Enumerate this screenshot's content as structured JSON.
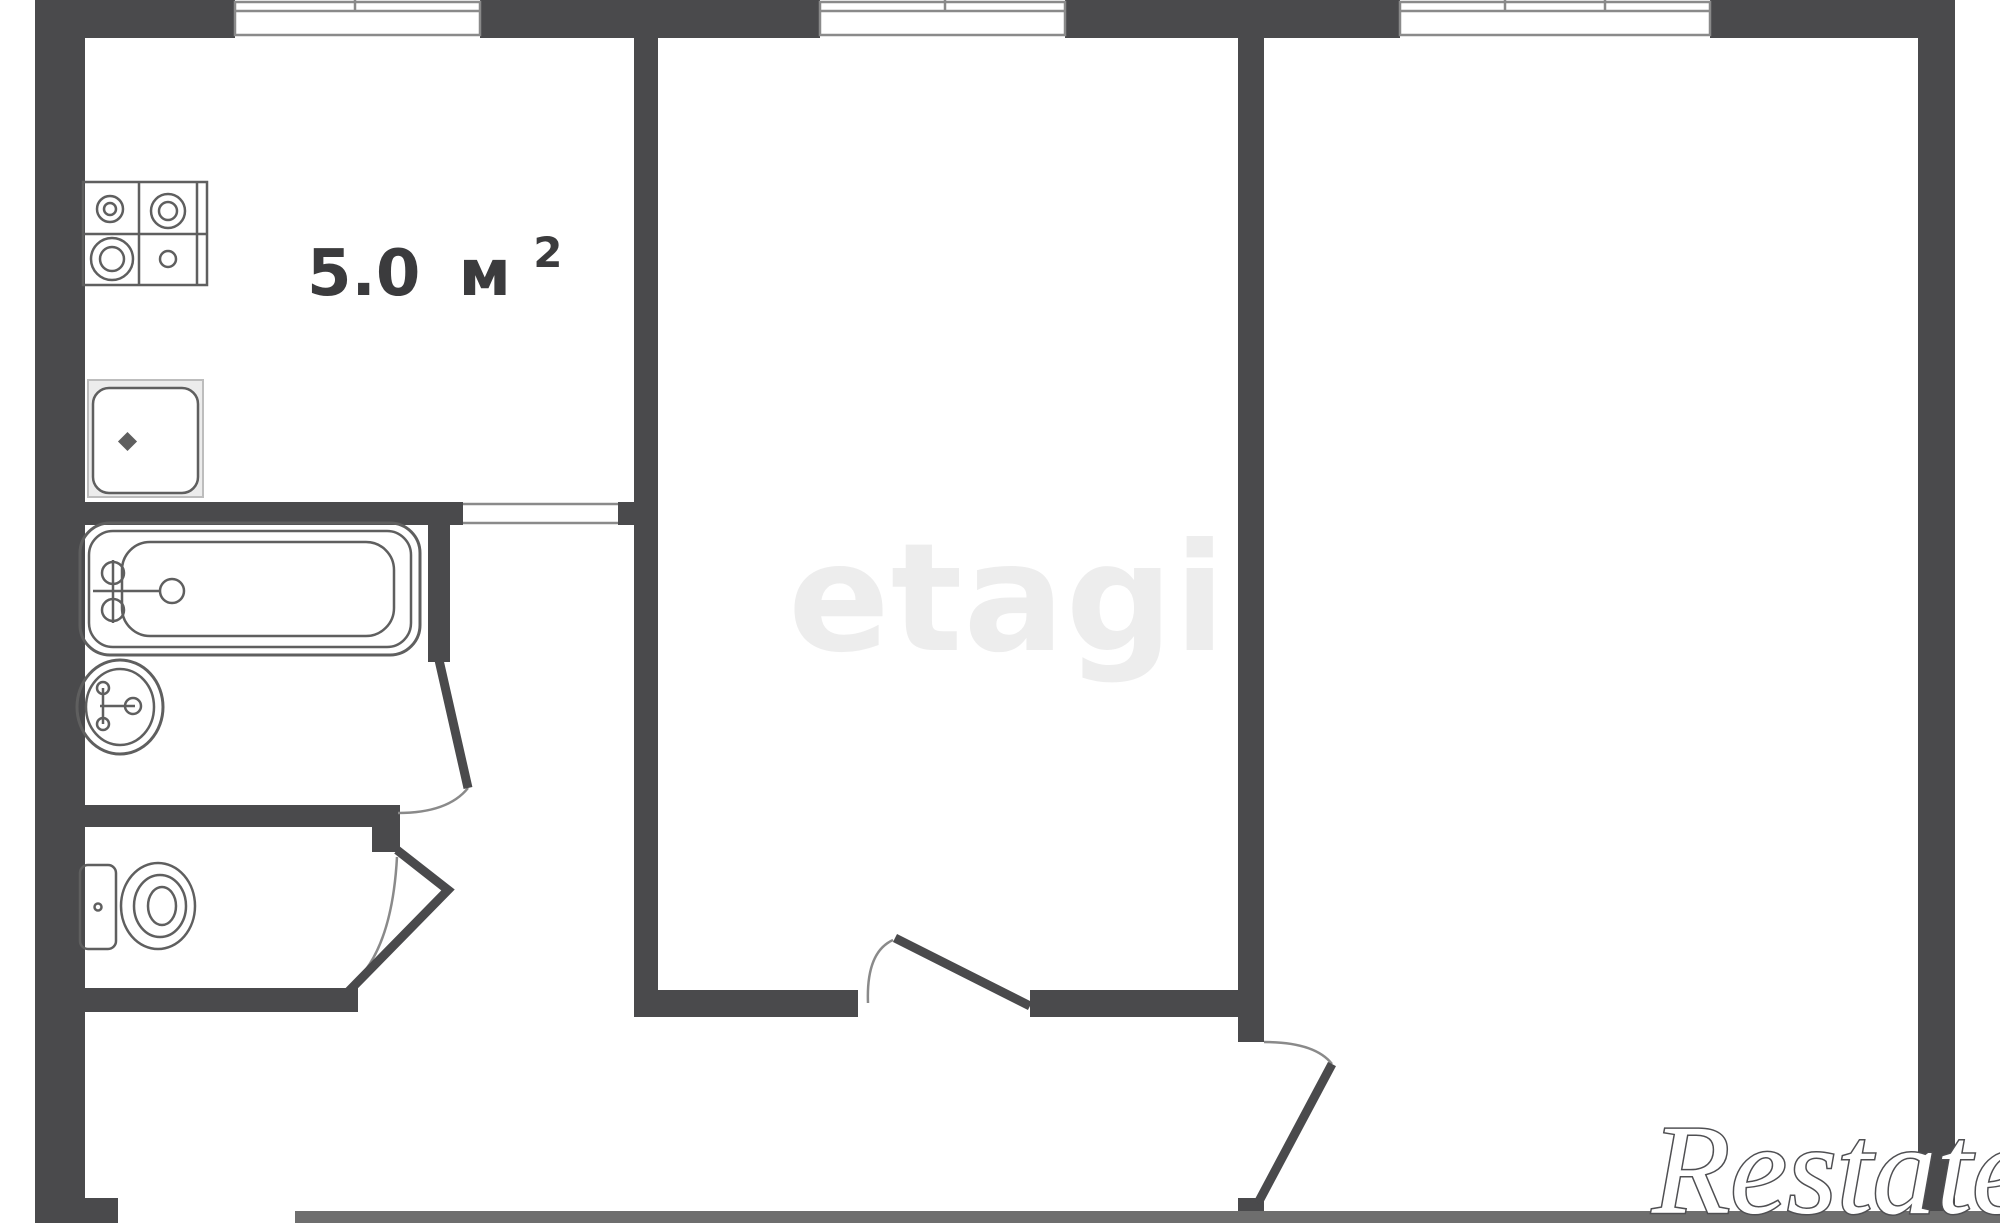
{
  "watermarks": {
    "center": "etagi",
    "corner": "Restate"
  },
  "labels": {
    "kitchen_area": {
      "value": "5.0",
      "unit": "м",
      "superscript": "2"
    }
  },
  "fixtures": [
    "stove-icon",
    "kitchen-sink-icon",
    "bathtub-icon",
    "washbasin-icon",
    "toilet-icon"
  ],
  "windows": {
    "count": 3
  },
  "doors": {
    "count": 4
  },
  "colors": {
    "wall": "#4a4a4c",
    "thin_wall": "#6e6e6e",
    "door_arc": "#8a8a8a",
    "window_frame": "#8a8a8a",
    "fixture": "#5f5f5f",
    "sink_fill": "#ececec",
    "label": "#3b3b3d",
    "watermark_center": "#ededed",
    "watermark_corner_fill": "#ffffff",
    "watermark_corner_stroke": "#4f4f52"
  }
}
